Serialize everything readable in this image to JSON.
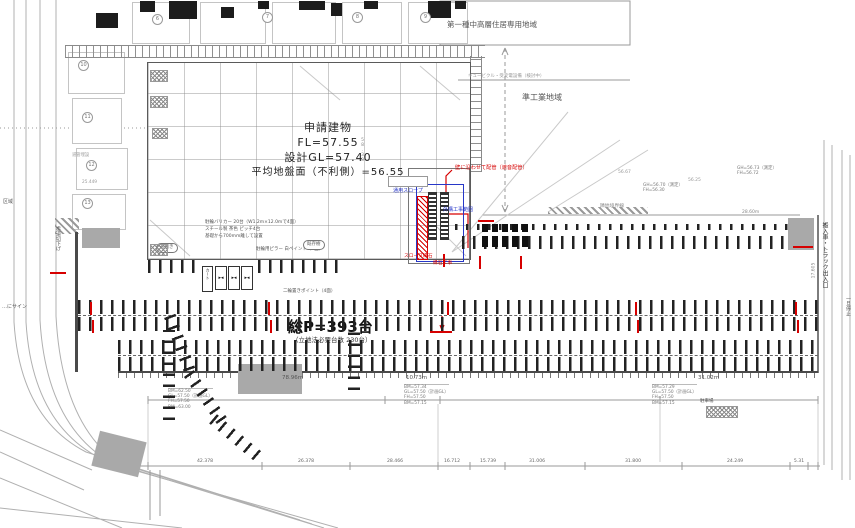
{
  "zoning": {
    "residential": "第一種中高層住居専用地域",
    "industrial": "準工業地域",
    "equipment_note": "キュービクル・受変電設備（検討中）",
    "boundary_label": "隣地境界線"
  },
  "building": {
    "name": "申請建物",
    "fl": "FL=57.55",
    "gl": "設計GL=57.40",
    "ground": "平均地盤面（不利側）=56.55"
  },
  "parking": {
    "total": "総P=393台",
    "required": "（立地法必要台数 230台）",
    "bike_note_1": "駐輪バリカー 20台（W1.2m×12.0mで4面）",
    "bike_note_2": "スチール製 茶色 ピッチ4台",
    "bike_note_3": "基礎から700mm離して設置",
    "bike_note_4": "駐輪用ピラー 白ペイント（4面）",
    "moto_note": "二輪置きポイント（4面）",
    "cart_glyph": "▸◂",
    "cart_label": "カート",
    "oval_1": "荷捌き",
    "oval_2": "既存樹"
  },
  "red_notes": {
    "pipe": "壁に沿わせて配管（遮音配管）",
    "slope_curb": "スロープ縁石",
    "curb_work": "縁石工事"
  },
  "blue_notes": {
    "slope": "通用スロープ",
    "gaikou": "外構工事範囲"
  },
  "roads": {
    "right_entrance": "搬入車・トラック出入口",
    "right_stop": "一旦停止",
    "left_walk": "歩道切下げ",
    "left_sign": "…にサイン",
    "left_area": "区域",
    "left_pipe": "道管埋設",
    "left_dim": "25.449"
  },
  "levels": {
    "b1": [
      "GH=56.70（測定）",
      "FH=56.30"
    ],
    "b2": [
      "GH=56.73（測定）",
      "FH=56.72"
    ],
    "spot_1": "56.67",
    "spot_2": "56.25",
    "spot_3": "58.38",
    "seg_note": "28.60m"
  },
  "dimensions": {
    "upper_left": "78.96m",
    "upper_mid": "10.73m",
    "upper_right": "31.02m",
    "right_vertical": "17.605",
    "chain": [
      "42.378",
      "26.378",
      "28.466",
      "16.712",
      "15.739",
      "31.006",
      "31.800",
      "24.249",
      "5.31"
    ]
  },
  "benchmarks": {
    "left": [
      "BM=62.50",
      "GL=57.50（計画GL）",
      "FH=57.50",
      "BM=63.00"
    ],
    "mid": [
      "BM=57.34",
      "GL=57.50（計画GL）",
      "FH=57.50",
      "BM=57.15"
    ],
    "right": [
      "BM=57.29",
      "GL=57.50（計画GL）",
      "FH=57.50",
      "BM=57.15"
    ],
    "right_extra": "駐車場"
  },
  "neighbor_marks": [
    "6",
    "7",
    "8",
    "9",
    "10",
    "11",
    "12",
    "13"
  ]
}
